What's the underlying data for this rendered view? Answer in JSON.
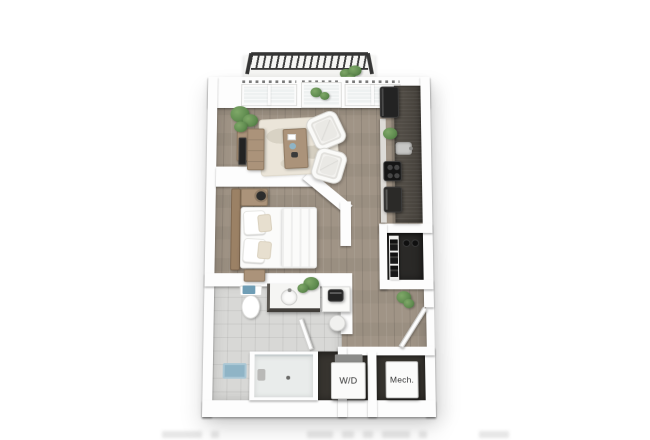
{
  "scene": {
    "kind": "3d-floor-plan-rendering"
  },
  "labels": {
    "washer_dryer": "W/D",
    "mechanical": "Mech."
  },
  "rooms": [
    "balcony",
    "living-area",
    "kitchen",
    "bedroom",
    "bathroom",
    "walk-in-closet",
    "laundry-closet",
    "mechanical-closet",
    "entry-hall"
  ],
  "colors": {
    "background": "#ffffff",
    "wall": "#fdfdfd",
    "wood_floor": "#a09486",
    "tile_floor": "#d8d8d6",
    "dark_closet": "#2a2927",
    "laundry_dark": "#37342f",
    "kitchen_counter": "#44403a",
    "appliance_dark": "#232323",
    "railing": "#353535",
    "coverlet_sage": "#b7bfb2",
    "rug_cream": "#ebe5d9",
    "wood_furniture": "#ab937a",
    "headboard_wood": "#9b8165",
    "plant_green": "#5f8b4f",
    "towel_blue": "#6f9db5",
    "mat_blue": "#8fb4c6",
    "glass_gray": "#eef1f1",
    "label_text": "#333333"
  }
}
